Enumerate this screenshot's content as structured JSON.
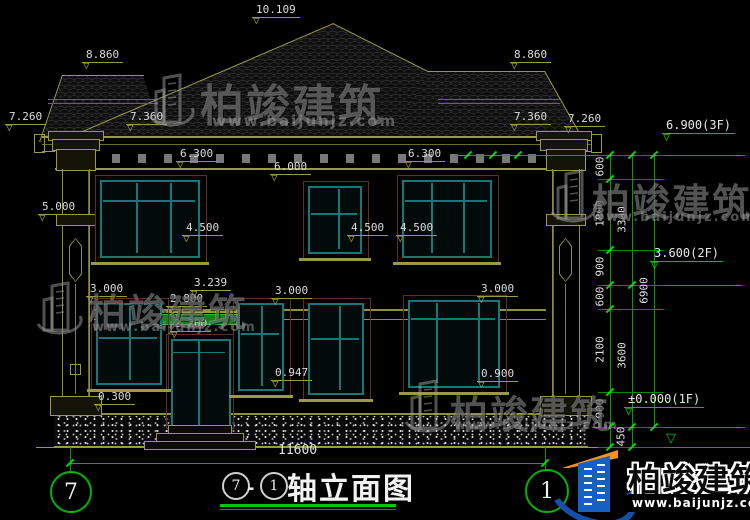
{
  "drawing": {
    "type": "architectural-elevation",
    "background": "#000000"
  },
  "title": {
    "axis_from": "7",
    "separator": "-",
    "axis_to": "1",
    "text": "轴立面图"
  },
  "axis_bubbles": {
    "left": "7",
    "right": "1"
  },
  "dimensions": {
    "overall_width": "11600",
    "elevation_markers": [
      {
        "label": "10.109",
        "x": 252,
        "y": 3
      },
      {
        "label": "8.860",
        "x": 82,
        "y": 48
      },
      {
        "label": "8.860",
        "x": 510,
        "y": 48
      },
      {
        "label": "7.260",
        "x": 5,
        "y": 110
      },
      {
        "label": "7.360",
        "x": 126,
        "y": 110
      },
      {
        "label": "7.360",
        "x": 510,
        "y": 110
      },
      {
        "label": "7.260",
        "x": 564,
        "y": 112
      },
      {
        "label": "6.300",
        "x": 176,
        "y": 147
      },
      {
        "label": "6.300",
        "x": 404,
        "y": 147
      },
      {
        "label": "6.000",
        "x": 270,
        "y": 160
      },
      {
        "label": "5.000",
        "x": 38,
        "y": 200
      },
      {
        "label": "4.500",
        "x": 182,
        "y": 221
      },
      {
        "label": "4.500",
        "x": 347,
        "y": 221
      },
      {
        "label": "4.500",
        "x": 396,
        "y": 221
      },
      {
        "label": "3.239",
        "x": 190,
        "y": 276
      },
      {
        "label": "3.000",
        "x": 86,
        "y": 282
      },
      {
        "label": "3.000",
        "x": 271,
        "y": 284
      },
      {
        "label": "3.000",
        "x": 477,
        "y": 282
      },
      {
        "label": "2.800",
        "x": 166,
        "y": 292
      },
      {
        "label": "2.200",
        "x": 170,
        "y": 317
      },
      {
        "label": "0.947",
        "x": 271,
        "y": 366
      },
      {
        "label": "0.900",
        "x": 477,
        "y": 367
      },
      {
        "label": "0.300",
        "x": 94,
        "y": 390
      }
    ],
    "level_labels": [
      {
        "label": "6.900(3F)",
        "x": 662,
        "y": 118
      },
      {
        "label": "3.600(2F)",
        "x": 650,
        "y": 246
      },
      {
        "label": "±0.000(1F)",
        "x": 624,
        "y": 392
      }
    ],
    "chain_numbers": [
      {
        "label": "600",
        "x": 600,
        "y": 167
      },
      {
        "label": "1800",
        "x": 600,
        "y": 214
      },
      {
        "label": "900",
        "x": 600,
        "y": 267
      },
      {
        "label": "600",
        "x": 600,
        "y": 297
      },
      {
        "label": "2100",
        "x": 600,
        "y": 350
      },
      {
        "label": "900",
        "x": 600,
        "y": 409
      },
      {
        "label": "450",
        "x": 621,
        "y": 437
      },
      {
        "label": "3300",
        "x": 622,
        "y": 220
      },
      {
        "label": "3600",
        "x": 622,
        "y": 356
      },
      {
        "label": "6900",
        "x": 644,
        "y": 291
      }
    ]
  },
  "watermark": {
    "brand": "柏竣建筑",
    "url": "www.baijunjz.com",
    "instances": [
      {
        "x": 146,
        "y": 72,
        "bx": 200,
        "by": 70,
        "bsize": 44,
        "ux": 212,
        "uy": 112,
        "usize": 15
      },
      {
        "x": 34,
        "y": 280,
        "bx": 88,
        "by": 282,
        "bsize": 38,
        "ux": 92,
        "uy": 320,
        "usize": 13
      },
      {
        "x": 548,
        "y": 168,
        "bx": 592,
        "by": 172,
        "bsize": 38,
        "ux": 592,
        "uy": 210,
        "usize": 13
      },
      {
        "x": 402,
        "y": 378,
        "bx": 450,
        "by": 384,
        "bsize": 38,
        "ux": 454,
        "uy": 418,
        "usize": 13
      }
    ]
  },
  "logo": {
    "brand": "柏竣建筑",
    "url": "www.baijunjz.com"
  },
  "colors": {
    "dim_line_olive": "#9a9a46",
    "dim_line_green": "#00c400",
    "window_frame_teal": "#147878",
    "window_surround_brown": "#5a3123",
    "canopy_green": "#15801c",
    "text": "#dcdcdc"
  }
}
